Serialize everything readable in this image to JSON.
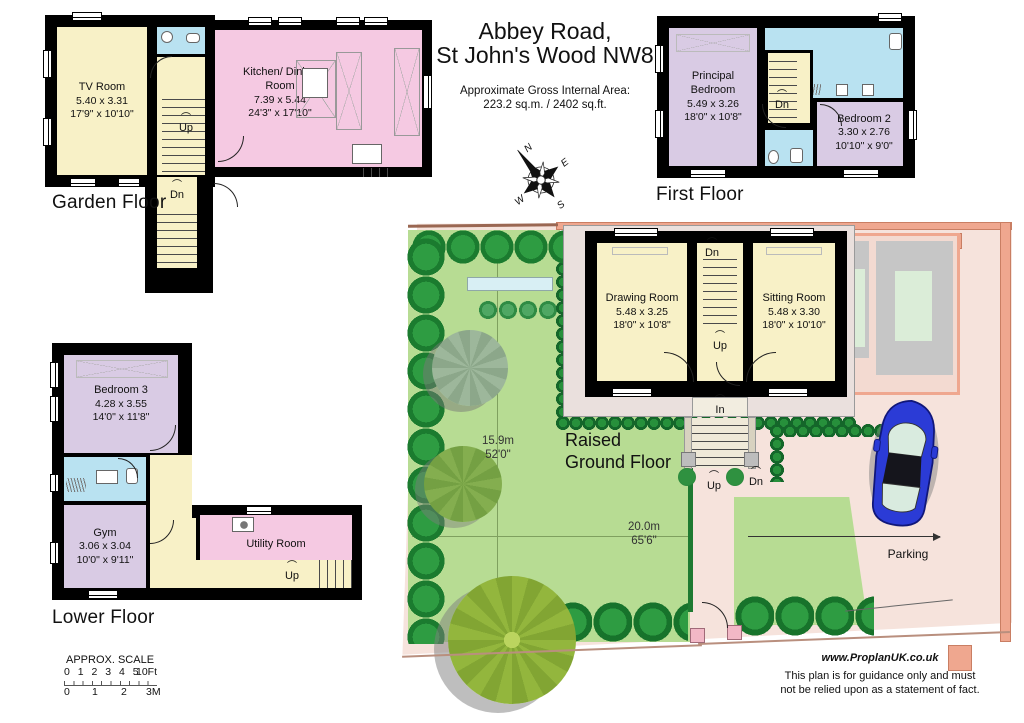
{
  "header": {
    "title_line1": "Abbey Road,",
    "title_line2": "St John's Wood NW8",
    "area_label": "Approximate Gross Internal Area:",
    "area_value": "223.2 sq.m. / 2402 sq.ft."
  },
  "compass": {
    "n": "N",
    "e": "E",
    "s": "S",
    "w": "W"
  },
  "stair_labels": {
    "up": "Up",
    "dn": "Dn",
    "in": "In"
  },
  "floors": {
    "garden": {
      "label": "Garden Floor",
      "rooms": [
        {
          "name": "TV Room",
          "metric": "5.40 x 3.31",
          "imperial": "17'9\" x 10'10\""
        },
        {
          "name": "Kitchen/ Dining Room",
          "metric": "7.39 x 5.44",
          "imperial": "24'3\" x 17'10\""
        }
      ]
    },
    "first": {
      "label": "First Floor",
      "rooms": [
        {
          "name": "Principal Bedroom",
          "metric": "5.49 x 3.26",
          "imperial": "18'0\" x 10'8\""
        },
        {
          "name": "Bedroom 2",
          "metric": "3.30 x 2.76",
          "imperial": "10'10\" x 9'0\""
        }
      ]
    },
    "lower": {
      "label": "Lower Floor",
      "rooms": [
        {
          "name": "Bedroom 3",
          "metric": "4.28 x 3.55",
          "imperial": "14'0\" x 11'8\""
        },
        {
          "name": "Gym",
          "metric": "3.06 x 3.04",
          "imperial": "10'0\" x 9'11\""
        },
        {
          "name": "Utility Room"
        }
      ]
    },
    "raised": {
      "label_line1": "Raised",
      "label_line2": "Ground Floor",
      "rooms": [
        {
          "name": "Drawing Room",
          "metric": "5.48 x 3.25",
          "imperial": "18'0\" x 10'8\""
        },
        {
          "name": "Sitting Room",
          "metric": "5.48 x 3.30",
          "imperial": "18'0\" x 10'10\""
        }
      ]
    }
  },
  "site": {
    "garden_depth_m": "15.9m",
    "garden_depth_ft": "52'0\"",
    "garden_width_m": "20.0m",
    "garden_width_ft": "65'6\"",
    "parking_label": "Parking"
  },
  "scale": {
    "title": "APPROX. SCALE",
    "ft_numbers": "0 1 2 3 4 5",
    "ft_end": "10Ft",
    "m_numbers": [
      "0",
      "1",
      "2",
      "3M"
    ]
  },
  "footer": {
    "website": "www.ProplanUK.co.uk",
    "disclaimer_line1": "This plan is for guidance only and must",
    "disclaimer_line2": "not be relied upon as a statement of fact."
  }
}
